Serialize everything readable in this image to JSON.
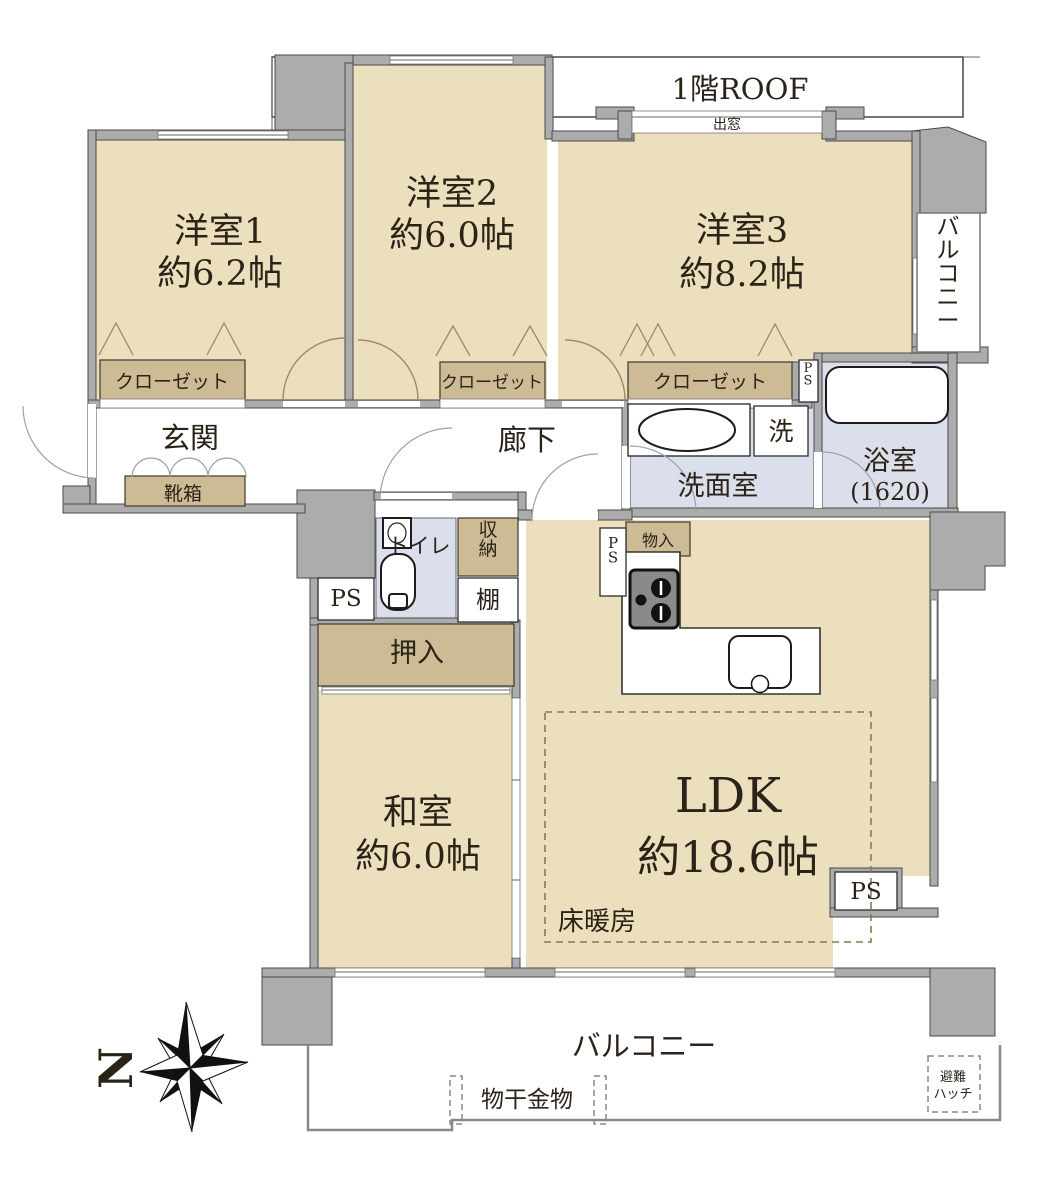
{
  "floorplan": {
    "roof_label": "1階ROOF",
    "bay_window": "出窓",
    "rooms": {
      "bedroom1": {
        "name": "洋室1",
        "size": "約6.2帖"
      },
      "bedroom2": {
        "name": "洋室2",
        "size": "約6.0帖"
      },
      "bedroom3": {
        "name": "洋室3",
        "size": "約8.2帖"
      },
      "japanese_room": {
        "name": "和室",
        "size": "約6.0帖"
      },
      "ldk": {
        "name": "LDK",
        "size": "約18.6帖"
      }
    },
    "labels": {
      "closet1": "クローゼット",
      "closet2": "クローゼット",
      "closet3": "クローゼット",
      "entrance": "玄関",
      "shoe_cabinet": "靴箱",
      "hallway": "廊下",
      "washroom": "洗面室",
      "washer": "洗",
      "bath_name": "浴室",
      "bath_size": "(1620)",
      "toilet": "トイレ",
      "storage": "収納",
      "shelf": "棚",
      "futon_closet": "押入",
      "cubby": "物入",
      "floor_heating": "床暖房",
      "balcony_right": "バルコニー",
      "balcony_bottom": "バルコニー",
      "laundry_fitting": "物干金物",
      "hatch_line1": "避難",
      "hatch_line2": "ハッチ",
      "ps": "PS",
      "north": "N"
    },
    "colors": {
      "room_beige": "#ebdfbd",
      "cabinet_tan": "#cdbb96",
      "wet_blue": "#dbdfeb",
      "wall_gray": "#acacac",
      "text": "#2b2318"
    }
  }
}
